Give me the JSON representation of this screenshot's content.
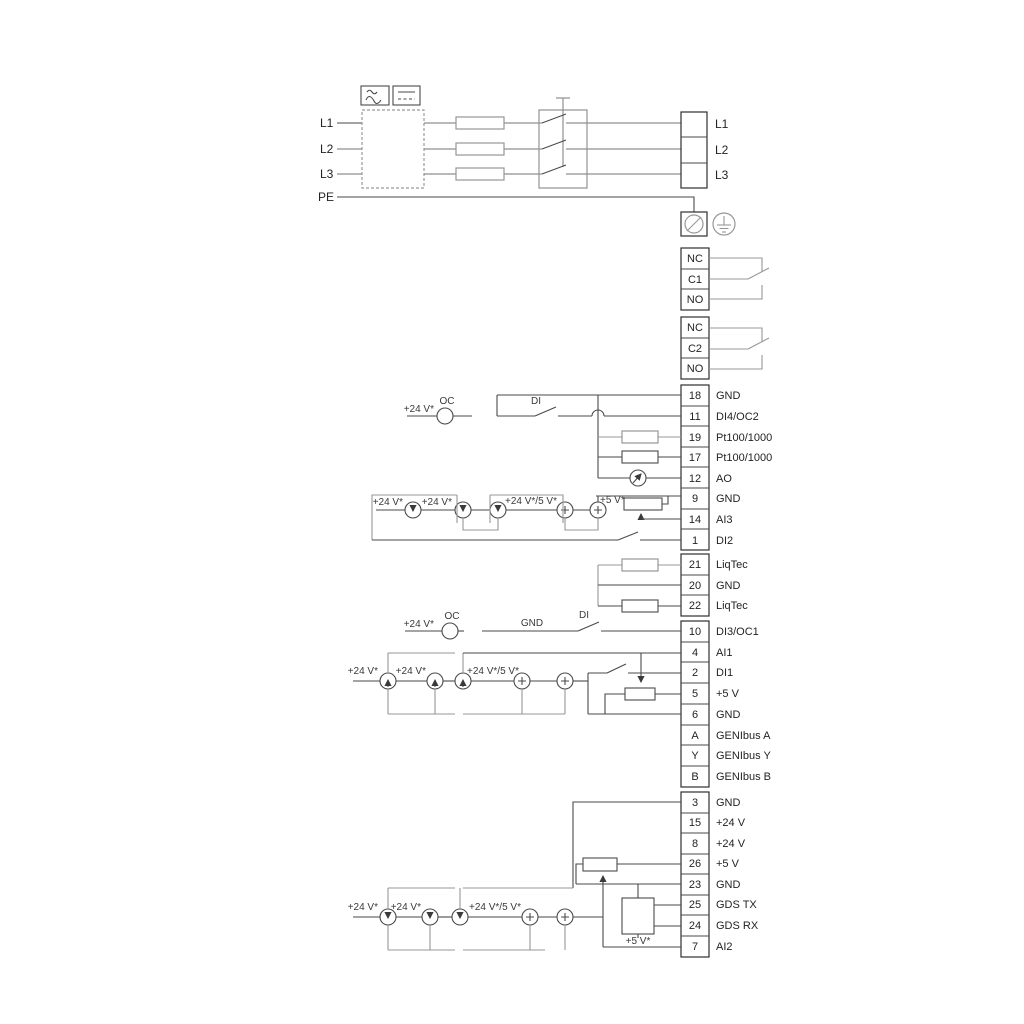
{
  "diagram": {
    "power_in": {
      "l1": "L1",
      "l2": "L2",
      "l3": "L3",
      "pe": "PE"
    },
    "power_out": {
      "l1": "L1",
      "l2": "L2",
      "l3": "L3"
    },
    "relay1": {
      "nc": "NC",
      "c": "C1",
      "no": "NO"
    },
    "relay2": {
      "nc": "NC",
      "c": "C2",
      "no": "NO"
    },
    "labels": {
      "v24": "+24 V*",
      "v24or5": "+24 V*/5 V*",
      "v5": "+5 V*",
      "oc": "OC",
      "di": "DI",
      "gnd": "GND"
    },
    "terminals_a": [
      {
        "n": "18",
        "label": "GND"
      },
      {
        "n": "11",
        "label": "DI4/OC2"
      },
      {
        "n": "19",
        "label": "Pt100/1000"
      },
      {
        "n": "17",
        "label": "Pt100/1000"
      },
      {
        "n": "12",
        "label": "AO"
      },
      {
        "n": "9",
        "label": "GND"
      },
      {
        "n": "14",
        "label": "AI3"
      },
      {
        "n": "1",
        "label": "DI2"
      }
    ],
    "terminals_liqtec": [
      {
        "n": "21",
        "label": "LiqTec"
      },
      {
        "n": "20",
        "label": "GND"
      },
      {
        "n": "22",
        "label": "LiqTec"
      }
    ],
    "terminals_b": [
      {
        "n": "10",
        "label": "DI3/OC1"
      },
      {
        "n": "4",
        "label": "AI1"
      },
      {
        "n": "2",
        "label": "DI1"
      },
      {
        "n": "5",
        "label": "+5 V"
      },
      {
        "n": "6",
        "label": "GND"
      },
      {
        "n": "A",
        "label": "GENIbus A"
      },
      {
        "n": "Y",
        "label": "GENIbus Y"
      },
      {
        "n": "B",
        "label": "GENIbus B"
      }
    ],
    "terminals_c": [
      {
        "n": "3",
        "label": "GND"
      },
      {
        "n": "15",
        "label": "+24 V"
      },
      {
        "n": "8",
        "label": "+24 V"
      },
      {
        "n": "26",
        "label": "+5 V"
      },
      {
        "n": "23",
        "label": "GND"
      },
      {
        "n": "25",
        "label": "GDS TX"
      },
      {
        "n": "24",
        "label": "GDS RX"
      },
      {
        "n": "7",
        "label": "AI2"
      }
    ]
  }
}
